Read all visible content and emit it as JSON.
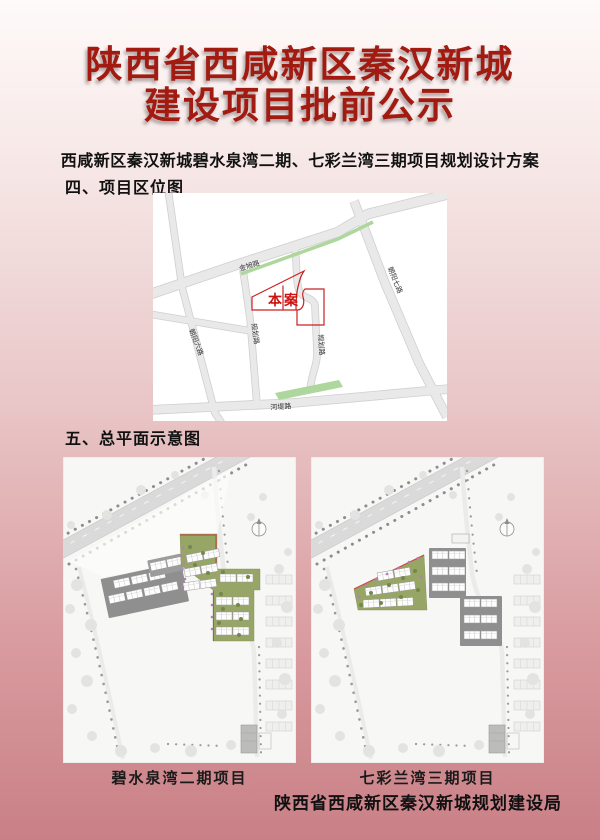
{
  "page": {
    "title_line1": "陕西省西咸新区秦汉新城",
    "title_line2": "建设项目批前公示",
    "subtitle": "西咸新区秦汉新城碧水泉湾二期、七彩兰湾三期项目规划设计方案",
    "section4_heading": "四、项目区位图",
    "section5_heading": "五、总平面示意图",
    "footer": "陕西省西咸新区秦汉新城规划建设局"
  },
  "colors": {
    "title_red": "#a21a10",
    "parcel_red": "#cc1111",
    "bg_top": "#fefaf9",
    "bg_bottom": "#c98086",
    "map_green": "#aed79e",
    "plan_green": "#97a566"
  },
  "location_map": {
    "parcel_label": "本案",
    "roads": [
      {
        "name": "金旭路"
      },
      {
        "name": "朝阳七路"
      },
      {
        "name": "规划路"
      },
      {
        "name": "规划路"
      },
      {
        "name": "朝阳六路"
      },
      {
        "name": "河堤路"
      }
    ]
  },
  "site_plans": [
    {
      "caption": "碧水泉湾二期项目"
    },
    {
      "caption": "七彩兰湾三期项目"
    }
  ]
}
